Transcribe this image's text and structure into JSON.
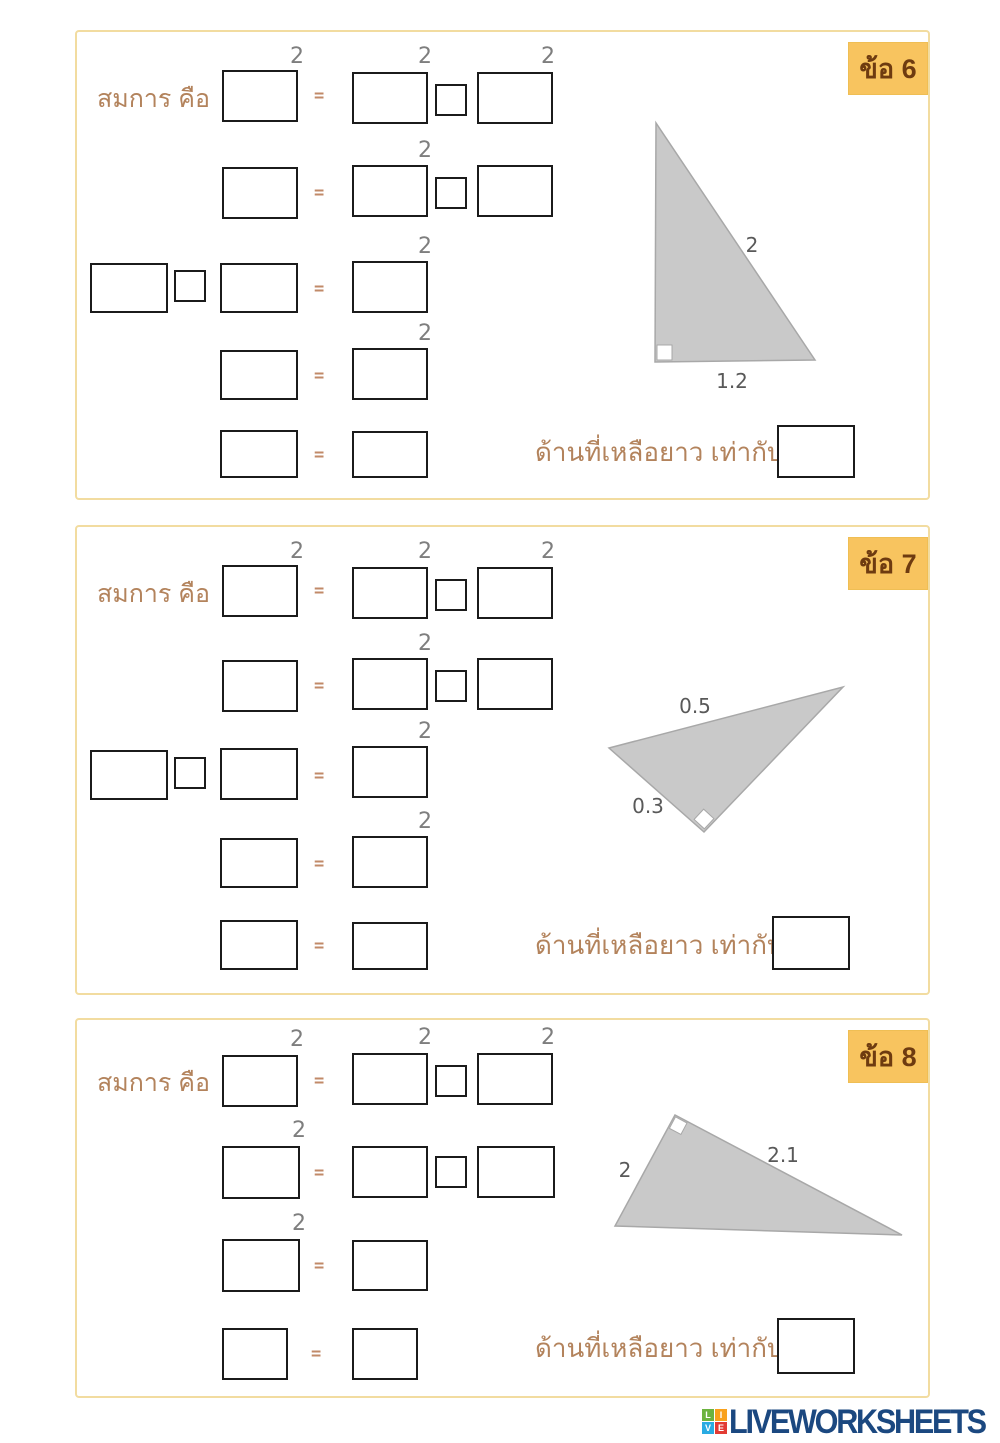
{
  "symbols": {
    "superscript": "2",
    "equals": "="
  },
  "sections": [
    {
      "badge": "ข้อ 6",
      "equation_label": "สมการ คือ",
      "answer_prompt": "ด้านที่เหลือยาว เท่ากับ",
      "triangle": {
        "label1": "2",
        "label2": "1.2"
      }
    },
    {
      "badge": "ข้อ 7",
      "equation_label": "สมการ คือ",
      "answer_prompt": "ด้านที่เหลือยาว เท่ากับ",
      "triangle": {
        "label1": "0.5",
        "label2": "0.3"
      }
    },
    {
      "badge": "ข้อ 8",
      "equation_label": "สมการ คือ",
      "answer_prompt": "ด้านที่เหลือยาว เท่ากับ",
      "triangle": {
        "label1": "2",
        "label2": "2.1"
      }
    }
  ],
  "footer": {
    "brand": "LIVEWORKSHEETS",
    "logo_letters": [
      "L",
      "I",
      "V",
      "E"
    ]
  },
  "colors": {
    "badge_bg": "#F8C45F",
    "badge_text": "#6E3B10",
    "label_brown": "#B3835C",
    "panel_border": "#F2DCA0",
    "triangle_fill": "#C9C9C9",
    "triangle_stroke": "#A8A8A8",
    "side_label_gray": "#595959",
    "superscript_gray": "#7E7E7E",
    "equals_tan": "#C18A68",
    "brand_navy": "#1B4880"
  }
}
